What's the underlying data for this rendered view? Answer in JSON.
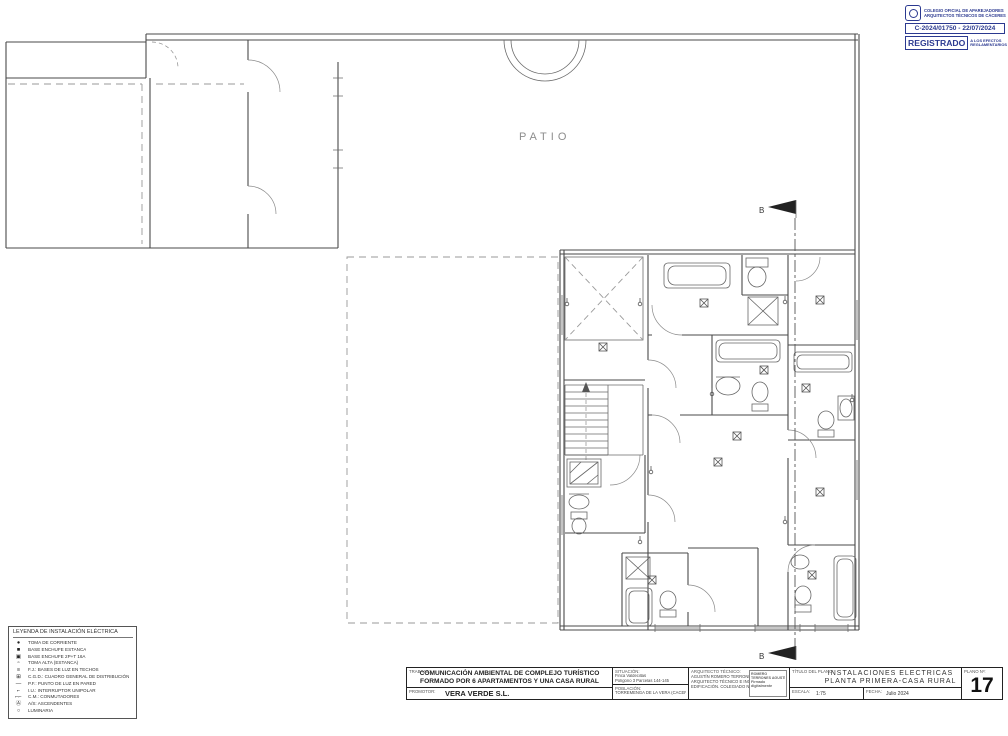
{
  "plan": {
    "patio_label": "PATIO",
    "section_marker": "B"
  },
  "legend": {
    "title": "LEYENDA DE INSTALACIÓN ELÉCTRICA",
    "items": [
      {
        "symbol": "●",
        "label": "TOMA DE CORRIENTE"
      },
      {
        "symbol": "■",
        "label": "BASE ENCHUFE ESTANCA"
      },
      {
        "symbol": "▣",
        "label": "BASE ENCHUFE 2P+T 16A"
      },
      {
        "symbol": "▫",
        "label": "TOMA ALTA (ESTANCA)"
      },
      {
        "symbol": "≡",
        "label": "F.J.:  BASES DE LUZ EN TECHOS"
      },
      {
        "symbol": "⊞",
        "label": "C.G.D.: CUADRO GENERAL DE DISTRIBUCIÓN"
      },
      {
        "symbol": "—",
        "label": "P.F.:  PUNTO DE LUZ EN PARED"
      },
      {
        "symbol": "⌐",
        "label": "I.U.:  INTERRUPTOR UNIPOLAR"
      },
      {
        "symbol": "⌐⌐",
        "label": "C.M.: CONMUTADORES"
      },
      {
        "symbol": "Ⓐ",
        "label": "A/S: ASCENDENTES"
      },
      {
        "symbol": "○",
        "label": "LUMINARIA"
      }
    ]
  },
  "titleblock": {
    "trabajo_label": "TRABAJO:",
    "trabajo_line1": "COMUNICACIÓN AMBIENTAL DE COMPLEJO TURÍSTICO",
    "trabajo_line2": "FORMADO POR 6 APARTAMENTOS Y UNA CASA RURAL",
    "promotor_label": "PROMOTOR:",
    "promotor_value": "VERA VERDE S.L.",
    "situacion_label": "SITUACIÓN:",
    "situacion_line1": "Finca Valdecillas",
    "situacion_line2": "Polígono 3 Parcelas 144-145",
    "poblacion_label": "POBLACIÓN:",
    "poblacion_value": "TORREMENGA DE LA VERA (CÁCERES)",
    "arquitecto_label": "ARQUITECTO TÉCNICO:",
    "arquitecto_line1": "AGUSTÍN ROMERO TERRONES",
    "arquitecto_line2": "ARQUITECTO TÉCNICO E INGENIERO DE",
    "arquitecto_line3": "EDIFICACIÓN. COLEGIADO Nº 708",
    "firma_line1": "ROMERO",
    "firma_line2": "TERRONES AGUSTÍN",
    "firma_line3": "Firmado",
    "firma_line4": "digitalmente",
    "titulo_label": "TÍTULO DEL PLANO:",
    "titulo_line1": "INSTALACIONES ELECTRICAS",
    "titulo_line2": "PLANTA PRIMERA-CASA RURAL",
    "escala_label": "ESCALA:",
    "escala_value": "1:75",
    "fecha_label": "FECHA:",
    "fecha_value": "Julio 2024",
    "plano_label": "PLANO Nº:",
    "plano_number": "17"
  },
  "stamp": {
    "college_line1": "COLEGIO OFICIAL DE APAREJADORES",
    "college_line2": "ARQUITECTOS TÉCNICOS DE CÁCERES",
    "registry_number": "C-2024/01750 - 22/07/2024",
    "registered_label": "REGISTRADO",
    "registered_note1": "A LOS EFECTOS",
    "registered_note2": "REGLAMENTARIOS",
    "accent_color": "#2b3990"
  }
}
